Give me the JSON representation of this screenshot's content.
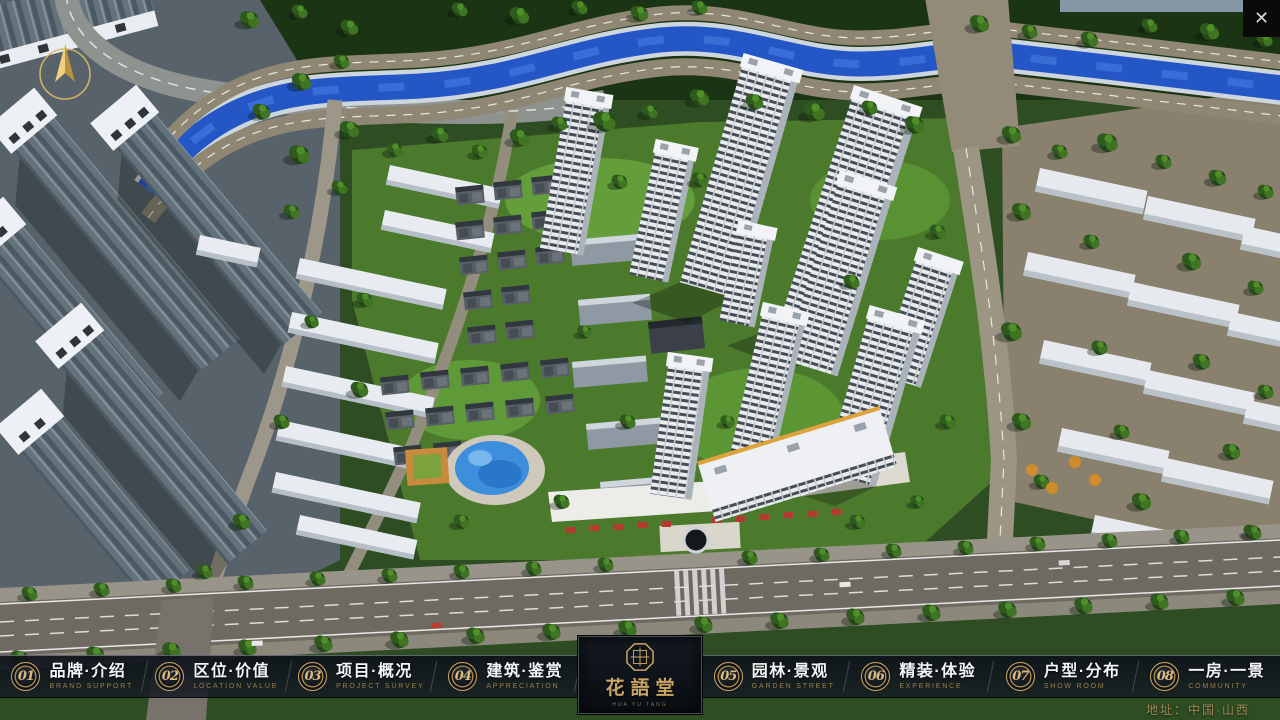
{
  "topbar": {
    "close_glyph": "✕"
  },
  "compass": {
    "direction": "N"
  },
  "logo": {
    "name": "花語堂",
    "caption": "HUA YU TANG"
  },
  "nav": {
    "items_left": [
      {
        "num": "01",
        "label": "品牌·介绍",
        "subtitle": "BRAND SUPPORT"
      },
      {
        "num": "02",
        "label": "区位·价值",
        "subtitle": "LOCATION VALUE"
      },
      {
        "num": "03",
        "label": "项目·概况",
        "subtitle": "PROJECT SURVEY"
      },
      {
        "num": "04",
        "label": "建筑·鉴赏",
        "subtitle": "APPRECIATION"
      }
    ],
    "items_right": [
      {
        "num": "05",
        "label": "园林·景观",
        "subtitle": "GARDEN STREET"
      },
      {
        "num": "06",
        "label": "精装·体验",
        "subtitle": "EXPERIENCE"
      },
      {
        "num": "07",
        "label": "户型·分布",
        "subtitle": "SHOW ROOM"
      },
      {
        "num": "08",
        "label": "一房·一景",
        "subtitle": "COMMUNITY"
      }
    ]
  },
  "footer": {
    "address": "地址：中国·山西"
  },
  "colors": {
    "gold": "#c9a565",
    "panel_dark": "#0d1117",
    "river_blue": "#2456c6"
  }
}
